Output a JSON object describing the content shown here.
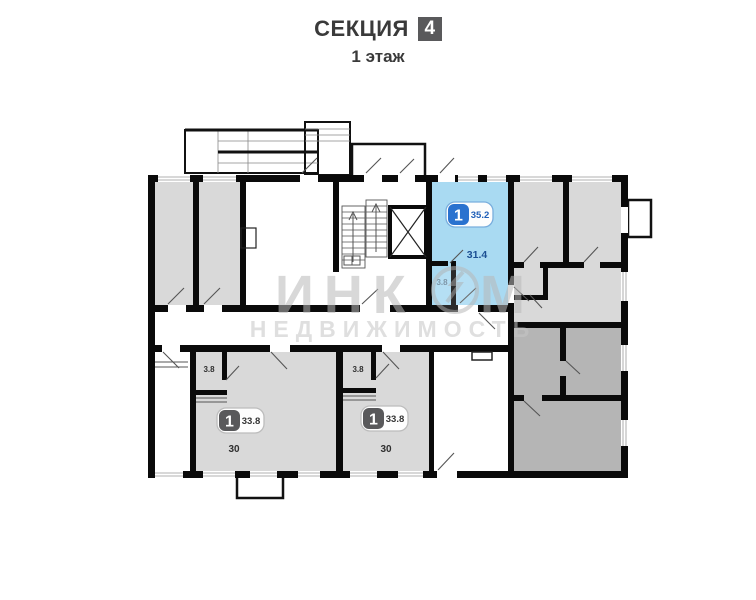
{
  "header": {
    "section_label": "СЕКЦИЯ",
    "section_number": "4",
    "floor_label": "1 этаж"
  },
  "watermark": {
    "brand_left": "ИНК",
    "brand_right": "М",
    "brand_sub": "НЕДВИЖИМОСТЬ"
  },
  "apartments": [
    {
      "name": "highlighted-studio",
      "badge_rooms": "1",
      "total_area": "35.2",
      "room_area": "31.4",
      "balcony_area": "3.8",
      "highlighted": true,
      "accent": "#2a72cf",
      "fill": "#a9daf2"
    },
    {
      "name": "bottom-left-studio",
      "badge_rooms": "1",
      "total_area": "33.8",
      "room_area": "30",
      "balcony_area": "3.8",
      "highlighted": false,
      "accent": "#59595b",
      "fill": "#d9d9d9"
    },
    {
      "name": "bottom-middle-studio",
      "badge_rooms": "1",
      "total_area": "33.8",
      "room_area": "30",
      "balcony_area": "3.8",
      "highlighted": false,
      "accent": "#59595b",
      "fill": "#d9d9d9"
    }
  ],
  "colors": {
    "wall": "#0a0a0a",
    "room_light": "#d9d9d9",
    "room_dark": "#b5b5b5",
    "highlight": "#a9daf2",
    "badge_blue": "#2a72cf",
    "badge_gray": "#59595b",
    "title_text": "#3a3a3a",
    "blue_area_text": "#1c4f93"
  }
}
